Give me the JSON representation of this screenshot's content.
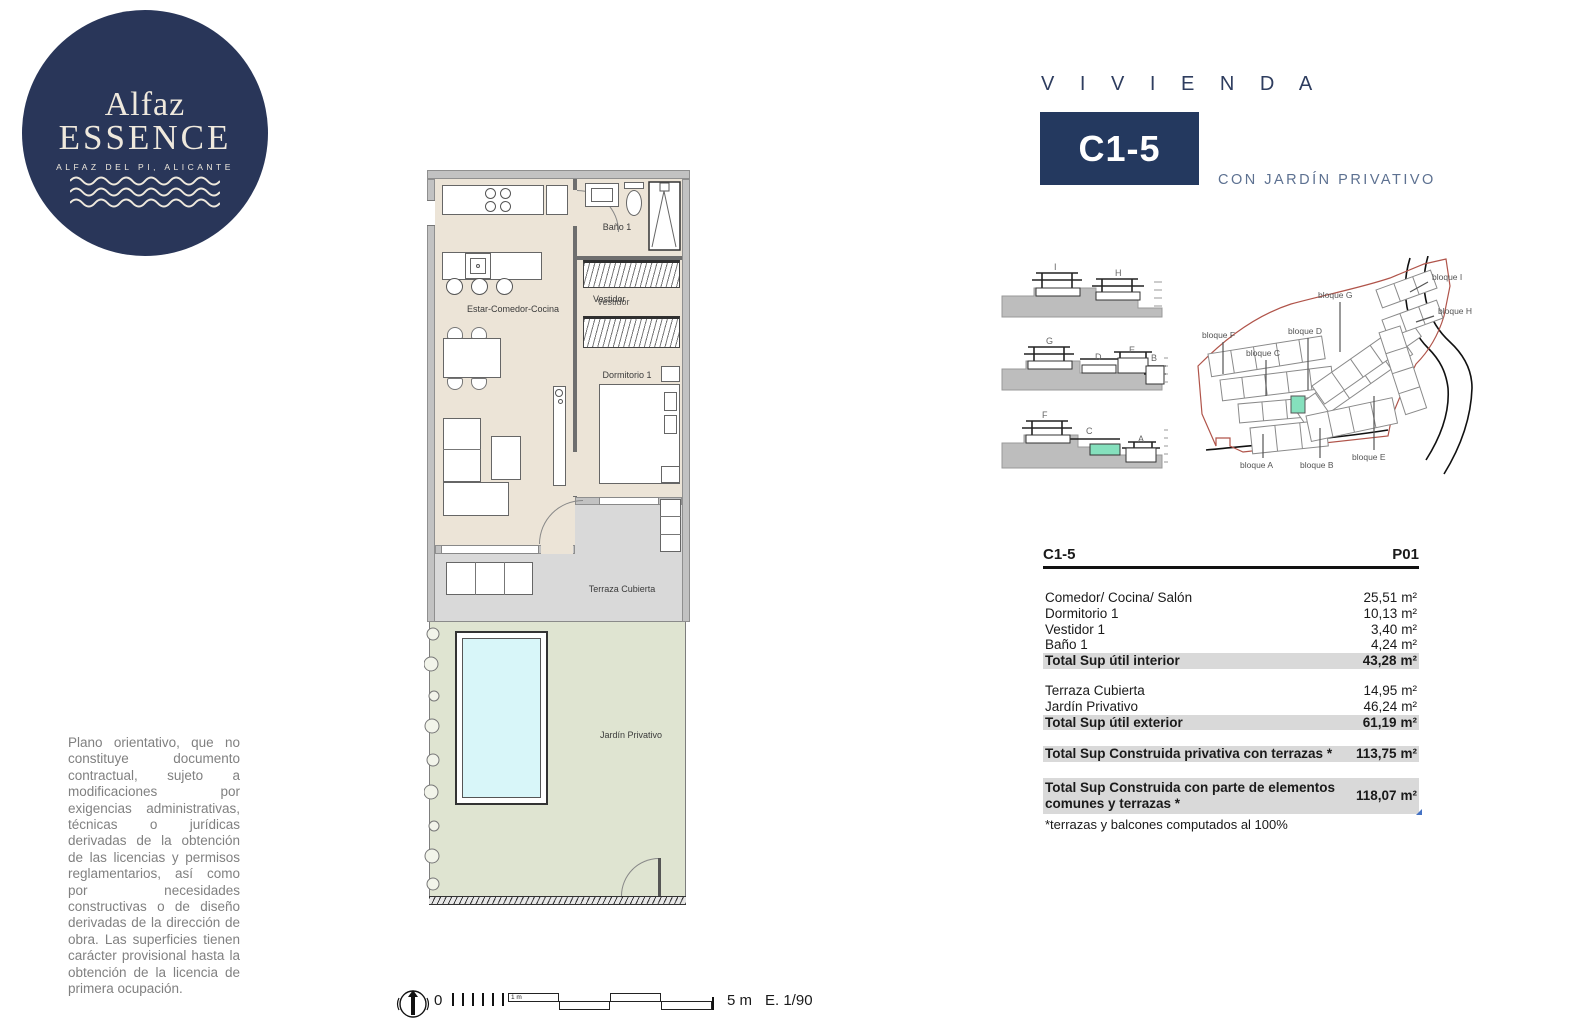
{
  "logo": {
    "name_top": "Alfaz",
    "name_main": "ESSENCE",
    "tagline": "ALFAZ DEL PI, ALICANTE"
  },
  "header": {
    "kicker": "V I V I E N D A",
    "unit": "C1-5",
    "subtitle": "CON JARDÍN PRIVATIVO"
  },
  "floorplan": {
    "rooms": {
      "bano": "Baño 1",
      "vestidor": "Vestidor",
      "vestidor_overlap": "Vestidor",
      "estar": "Estar-Comedor-Cocina",
      "dormitorio": "Dormitorio 1",
      "terraza": "Terraza Cubierta",
      "jardin": "Jardín Privativo"
    }
  },
  "elevations": {
    "rows": [
      [
        "I",
        "H"
      ],
      [
        "G",
        "D",
        "E",
        "B"
      ],
      [
        "F",
        "C",
        "A"
      ]
    ]
  },
  "siteplan": {
    "labels": [
      "bloque F",
      "bloque C",
      "bloque D",
      "bloque G",
      "bloque I",
      "bloque H",
      "bloque A",
      "bloque B",
      "bloque E"
    ]
  },
  "table": {
    "unit_code": "C1-5",
    "floor": "P01",
    "area_unit": "m²",
    "rows": [
      {
        "label": "Comedor/ Cocina/ Salón",
        "value": "25,51"
      },
      {
        "label": "Dormitorio 1",
        "value": "10,13"
      },
      {
        "label": "Vestidor 1",
        "value": "3,40"
      },
      {
        "label": "Baño 1",
        "value": "4,24"
      },
      {
        "label": "Total Sup útil interior",
        "value": "43,28"
      },
      {
        "label": "Terraza Cubierta",
        "value": "14,95"
      },
      {
        "label": "Jardín Privativo",
        "value": "46,24"
      },
      {
        "label": "Total Sup útil exterior",
        "value": "61,19"
      },
      {
        "label": "Total Sup Construida privativa con terrazas *",
        "value": "113,75"
      },
      {
        "label": "Total Sup Construida con parte de elementos comunes y terrazas *",
        "value": "118,07"
      }
    ],
    "footnote": "*terrazas y balcones computados al 100%"
  },
  "disclaimer": "Plano orientativo, que no constituye documento contractual, sujeto a modificaciones por exigencias administrativas, técnicas o jurídicas derivadas de la obtención de las licencias y permisos reglamentarios, así como por necesidades constructivas o de diseño derivadas de la dirección de obra. Las superficies tienen carácter provisional hasta la obtención de la licencia de primera ocupación.",
  "scalebar": {
    "zero": "0",
    "segment_label": "1 m",
    "end_label": "5 m",
    "scale_text": "E. 1/90"
  },
  "colors": {
    "navy": "#293659",
    "accent_teal": "#85e0bd",
    "interior_beige": "#ece4d7",
    "terrace_gray": "#d9d9d9",
    "garden_green": "#dfe4d1",
    "pool_cyan": "#d8f6f9",
    "total_row_gray": "#d9d9d9",
    "boundary_red": "#b0544a"
  }
}
